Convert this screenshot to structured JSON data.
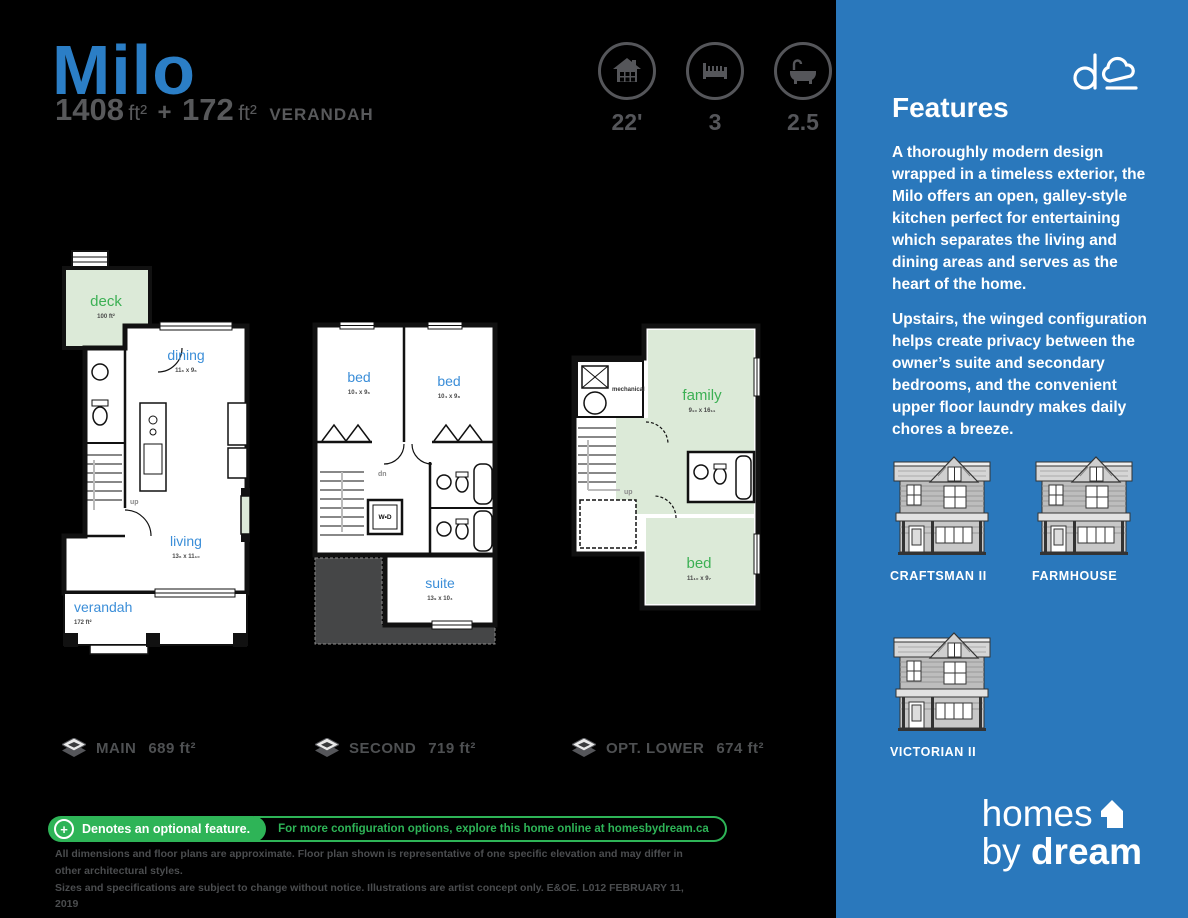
{
  "header": {
    "title": "Milo",
    "area": {
      "main_value": "1408",
      "main_unit": "ft²",
      "plus": "+",
      "verandah_value": "172",
      "verandah_unit": "ft²",
      "verandah_word": "VERANDAH"
    },
    "stats": [
      {
        "icon": "house-width-icon",
        "value": "22'"
      },
      {
        "icon": "bed-count-icon",
        "value": "3"
      },
      {
        "icon": "bath-count-icon",
        "value": "2.5"
      }
    ]
  },
  "plans": {
    "main": {
      "deck_name": "deck",
      "deck_area": "100 ft²",
      "dining_name": "dining",
      "dining_dims": "11₆ x 9₆",
      "living_name": "living",
      "living_dims": "13₆ x 11₁₀",
      "verandah_name": "verandah",
      "verandah_area": "172 ft²",
      "up_label": "up",
      "footer_name": "MAIN",
      "footer_area": "689 ft²"
    },
    "second": {
      "bed1_name": "bed",
      "bed1_dims": "10₄ x 9₆",
      "bed2_name": "bed",
      "bed2_dims": "10₄ x 9₈",
      "suite_name": "suite",
      "suite_dims": "13₉ x 10₄",
      "wd_label": "W•D",
      "dn_label": "dn",
      "footer_name": "SECOND",
      "footer_area": "719 ft²"
    },
    "lower": {
      "mechanical_label": "mechanical",
      "family_name": "family",
      "family_dims": "9₁₀ x 16₁₁",
      "bed_name": "bed",
      "bed_dims": "11₁₀ x 9₇",
      "up_label": "up",
      "footer_name": "OPT. LOWER",
      "footer_area": "674 ft²"
    }
  },
  "optional_bar": {
    "plus_symbol": "+",
    "left_text": "Denotes an optional feature.",
    "right_text": "For more configuration options, explore this home online at homesbydream.ca"
  },
  "disclaimer": {
    "line1": "All dimensions and floor plans are approximate. Floor plan shown is representative of one specific elevation and may differ in other architectural styles.",
    "line2": "Sizes and specifications are subject to change without notice. Illustrations are artist concept only. E&OE.  L012   FEBRUARY 11, 2019"
  },
  "sidebar": {
    "features_title": "Features",
    "paragraph1": "A thoroughly modern design wrapped in a timeless exterior, the Milo offers an open, galley-style kitchen perfect for entertaining which separates the living and dining areas and serves as the heart of the home.",
    "paragraph2": "Upstairs, the winged configuration helps create privacy between the owner’s suite and secondary bedrooms, and the convenient upper floor laundry makes daily chores a breeze.",
    "styles": [
      {
        "label": "CRAFTSMAN II"
      },
      {
        "label": "FARMHOUSE"
      },
      {
        "label": "VICTORIAN II"
      }
    ],
    "brand": {
      "homes": "homes",
      "by": "by",
      "dream": "dream"
    }
  },
  "colors": {
    "accent_blue": "#2a78bc",
    "title_blue": "#2b7ec6",
    "room_label_blue": "#3b8ed8",
    "green": "#2eb457",
    "room_green_fill": "#dcead8",
    "gray": "#58595b"
  }
}
